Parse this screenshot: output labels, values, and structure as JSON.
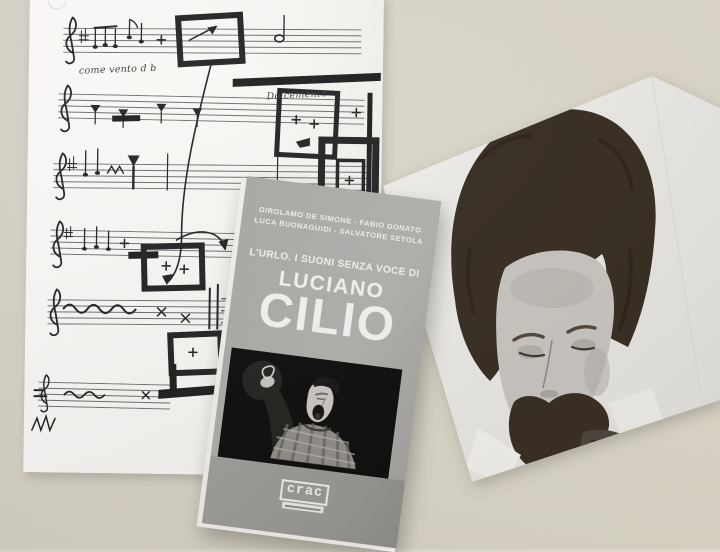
{
  "photo_scene": {
    "score_annotations": {
      "wind": "come vento d b",
      "dolce": "Dolcemente"
    },
    "book_cover": {
      "authors_line1": "GIROLAMO DE SIMONE - FABIO DONATO",
      "authors_line2": "LUCA BUONAGUIDI - SALVATORE SETOLA",
      "subtitle": "L'URLO. I SUONI SENZA VOCE DI",
      "title_first_name": "LUCIANO",
      "title_surname": "CILIO",
      "publisher": "crac"
    },
    "colors": {
      "table": "#d9d4c9",
      "sheet_white": "#f8f7f4",
      "cover_gray": "#a9a7a4",
      "cover_band_gray": "#9a9894",
      "photo_black": "#0d0c0b",
      "cover_text": "#f4f3f1"
    }
  }
}
